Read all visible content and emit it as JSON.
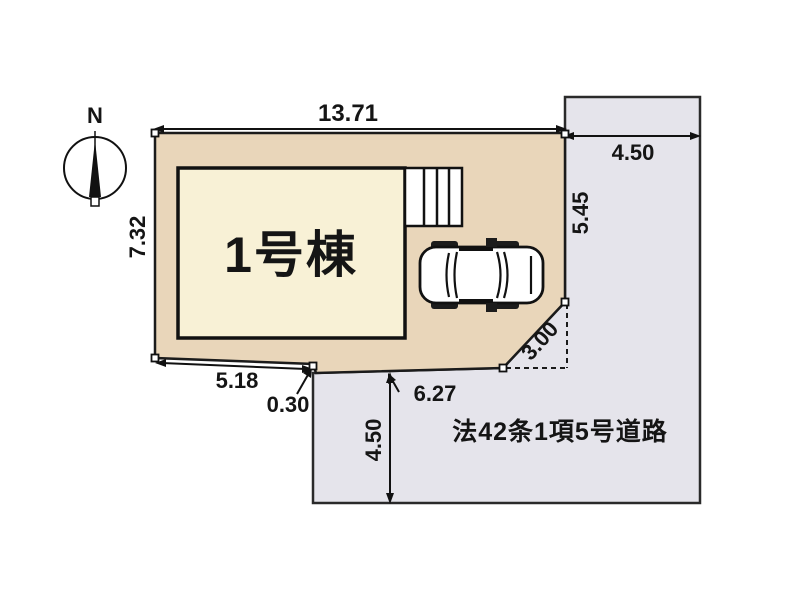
{
  "compass": {
    "label": "N"
  },
  "site_plan": {
    "plot": {
      "fill": "#e9d6ba",
      "outline": "#1b1b1b"
    },
    "building": {
      "label": "1号棟",
      "fill": "#f8f1d6"
    },
    "road": {
      "label": "法42条1項5号道路",
      "fill": "#e5e4eb"
    },
    "dimensions": {
      "top_width": "13.71",
      "left_depth": "7.32",
      "right_depth": "5.45",
      "road_top_width": "4.50",
      "bottom_left": "5.18",
      "setback": "0.30",
      "bottom_right": "6.27",
      "corner_cut": "3.00",
      "road_bottom_width": "4.50"
    }
  }
}
